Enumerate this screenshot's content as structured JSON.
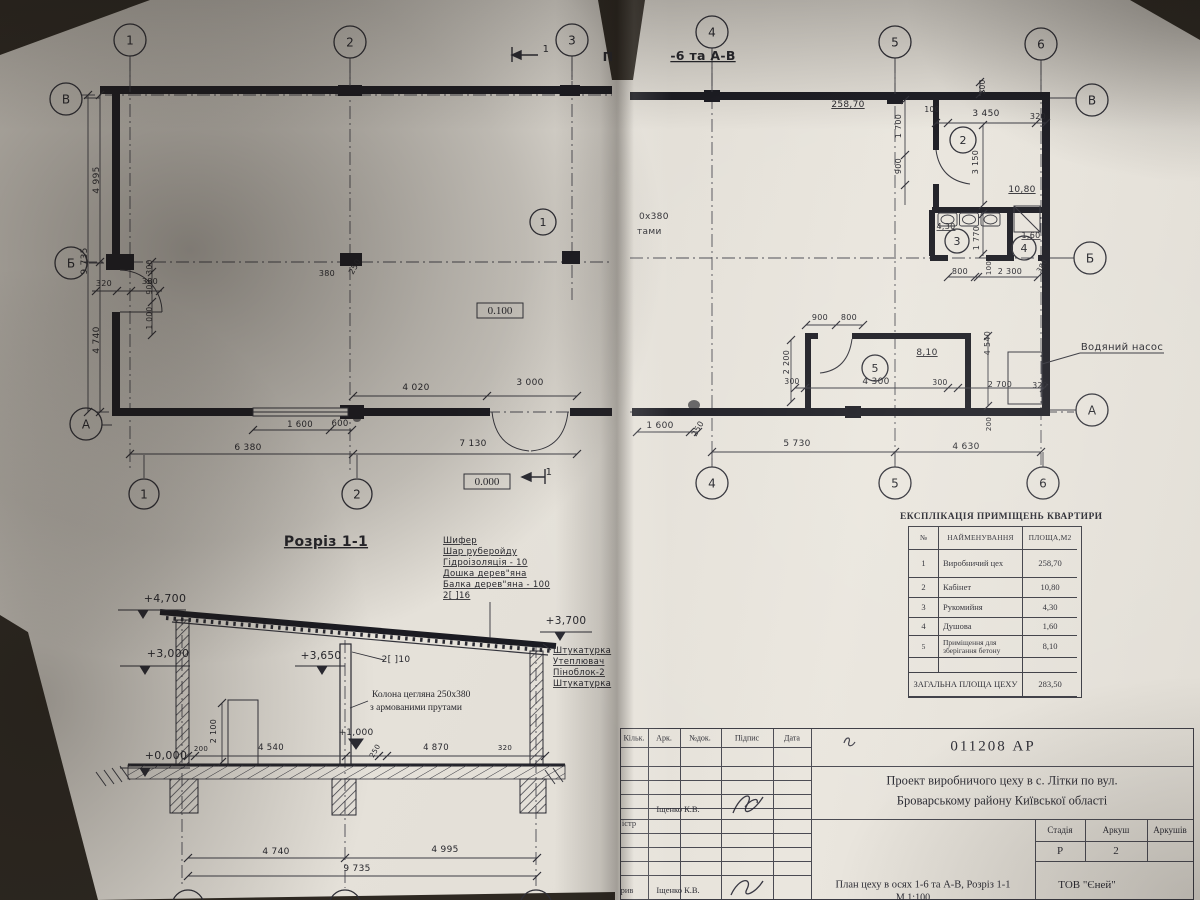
{
  "page": {
    "background": "#342e27",
    "paper": "#e6e2da",
    "ink": "#26262e"
  },
  "drawing": {
    "labels": [
      {
        "t": "П",
        "x": 608,
        "y": 61,
        "s": 12.5,
        "b": 1,
        "n": "sheet-title-fragment"
      },
      {
        "t": "-6 та А-В",
        "x": 703,
        "y": 60,
        "s": 12.5,
        "b": 1,
        "u": 1,
        "n": "sheet-title-fragment"
      },
      {
        "t": "4 995",
        "x": 99,
        "y": 180,
        "r": -90
      },
      {
        "t": "9 735",
        "x": 87,
        "y": 261,
        "r": -90
      },
      {
        "t": "4 740",
        "x": 99,
        "y": 340,
        "r": -90
      },
      {
        "t": "320",
        "x": 104,
        "y": 286,
        "s": 8
      },
      {
        "t": "380",
        "x": 150,
        "y": 284,
        "s": 8
      },
      {
        "t": "300",
        "x": 152,
        "y": 267,
        "r": -90,
        "s": 7.5
      },
      {
        "t": "900",
        "x": 152,
        "y": 287,
        "r": -90,
        "s": 7.5
      },
      {
        "t": "1 000",
        "x": 152,
        "y": 318,
        "r": -90,
        "s": 7.5
      },
      {
        "t": "1 600",
        "x": 300,
        "y": 427,
        "s": 8.5
      },
      {
        "t": "600",
        "x": 340,
        "y": 426,
        "s": 8.5
      },
      {
        "t": "6 380",
        "x": 248,
        "y": 450
      },
      {
        "t": "7 130",
        "x": 473,
        "y": 446
      },
      {
        "t": "4 020",
        "x": 416,
        "y": 390
      },
      {
        "t": "3 000",
        "x": 530,
        "y": 385
      },
      {
        "t": "380",
        "x": 327,
        "y": 276,
        "s": 8
      },
      {
        "t": "250",
        "x": 357,
        "y": 268,
        "r": -60,
        "s": 8
      },
      {
        "t": "0.100",
        "x": 500,
        "y": 314,
        "s": 11,
        "f": "serif",
        "n": "level-label"
      },
      {
        "t": "0.000",
        "x": 487,
        "y": 485,
        "s": 11,
        "f": "serif",
        "n": "level-label"
      },
      {
        "t": "1",
        "x": 549,
        "y": 475,
        "s": 10,
        "n": "section-marker-label"
      },
      {
        "t": "1",
        "x": 546,
        "y": 52,
        "s": 10,
        "n": "section-marker-label"
      },
      {
        "t": "258,70",
        "x": 848,
        "y": 107,
        "u": 1
      },
      {
        "t": "200",
        "x": 985,
        "y": 87,
        "r": -90,
        "s": 7.5
      },
      {
        "t": "100",
        "x": 932,
        "y": 112,
        "s": 7.5
      },
      {
        "t": "3 450",
        "x": 986,
        "y": 116
      },
      {
        "t": "320",
        "x": 1038,
        "y": 119,
        "s": 8
      },
      {
        "t": "1 700",
        "x": 901,
        "y": 126,
        "r": -90,
        "s": 8
      },
      {
        "t": "900",
        "x": 901,
        "y": 166,
        "r": -90,
        "s": 8
      },
      {
        "t": "3 150",
        "x": 978,
        "y": 162,
        "r": -90,
        "s": 8
      },
      {
        "t": "10,80",
        "x": 1022,
        "y": 192,
        "u": 1
      },
      {
        "t": "4,30",
        "x": 946,
        "y": 229,
        "u": 1,
        "s": 8
      },
      {
        "t": "1,60",
        "x": 1031,
        "y": 238,
        "u": 1,
        "s": 8
      },
      {
        "t": "1 770",
        "x": 979,
        "y": 238,
        "r": -90,
        "s": 8
      },
      {
        "t": "100",
        "x": 991,
        "y": 268,
        "r": -90,
        "s": 7
      },
      {
        "t": "800",
        "x": 960,
        "y": 274,
        "s": 8
      },
      {
        "t": "2 300",
        "x": 1010,
        "y": 274,
        "s": 8
      },
      {
        "t": "380",
        "x": 1044,
        "y": 267,
        "r": -60,
        "s": 7
      },
      {
        "t": "900",
        "x": 820,
        "y": 320,
        "s": 8
      },
      {
        "t": "800",
        "x": 849,
        "y": 320,
        "s": 8
      },
      {
        "t": "2 200",
        "x": 789,
        "y": 362,
        "r": -90,
        "s": 8
      },
      {
        "t": "300",
        "x": 792,
        "y": 384,
        "s": 7.5
      },
      {
        "t": "4 300",
        "x": 876,
        "y": 384
      },
      {
        "t": "300",
        "x": 940,
        "y": 385,
        "s": 7.5
      },
      {
        "t": "8,10",
        "x": 927,
        "y": 355,
        "u": 1
      },
      {
        "t": "4 540",
        "x": 990,
        "y": 343,
        "r": -90,
        "s": 8
      },
      {
        "t": "2 700",
        "x": 1000,
        "y": 387,
        "s": 8
      },
      {
        "t": "320",
        "x": 1040,
        "y": 388,
        "s": 7.5
      },
      {
        "t": "1 600",
        "x": 660,
        "y": 428
      },
      {
        "t": "250",
        "x": 700,
        "y": 430,
        "r": -60,
        "s": 8
      },
      {
        "t": "5 730",
        "x": 797,
        "y": 446
      },
      {
        "t": "4 630",
        "x": 966,
        "y": 449
      },
      {
        "t": "200",
        "x": 991,
        "y": 424,
        "r": -90,
        "s": 7
      },
      {
        "t": "Водяний насос",
        "x": 1122,
        "y": 350,
        "s": 10,
        "n": "note-water-pump"
      },
      {
        "t": "0х380",
        "x": 639,
        "y": 219,
        "a": "start",
        "s": 9,
        "n": "note-fragment"
      },
      {
        "t": "тами",
        "x": 637,
        "y": 234,
        "a": "start",
        "s": 9,
        "n": "note-fragment"
      },
      {
        "t": "Розріз 1-1",
        "x": 326,
        "y": 546,
        "s": 14,
        "b": 1,
        "u": 1,
        "n": "section-title"
      },
      {
        "t": "Шифер",
        "x": 443,
        "y": 543,
        "a": "start",
        "s": 8.5,
        "u": 1
      },
      {
        "t": "Шар руберойду",
        "x": 443,
        "y": 554,
        "a": "start",
        "s": 8.5,
        "u": 1
      },
      {
        "t": "Гідроізоляція - 10",
        "x": 443,
        "y": 565,
        "a": "start",
        "s": 8.5,
        "u": 1
      },
      {
        "t": "Дошка дерев\"яна",
        "x": 443,
        "y": 576,
        "a": "start",
        "s": 8.5,
        "u": 1
      },
      {
        "t": "Балка дерев\"яна - 100",
        "x": 443,
        "y": 587,
        "a": "start",
        "s": 8.5,
        "u": 1
      },
      {
        "t": "2[ ]16",
        "x": 443,
        "y": 598,
        "a": "start",
        "s": 8.5,
        "u": 1
      },
      {
        "t": "+4,700",
        "x": 165,
        "y": 602,
        "s": 11
      },
      {
        "t": "+3,000",
        "x": 168,
        "y": 657,
        "s": 11
      },
      {
        "t": "+3,650",
        "x": 321,
        "y": 659,
        "s": 10.5
      },
      {
        "t": "+3,700",
        "x": 566,
        "y": 624,
        "s": 10.5
      },
      {
        "t": "+0,000",
        "x": 166,
        "y": 759,
        "s": 11
      },
      {
        "t": "+1,000",
        "x": 356,
        "y": 735,
        "s": 9
      },
      {
        "t": "2[ ]10",
        "x": 396,
        "y": 662,
        "s": 9
      },
      {
        "t": "Колона цегляна 250х380",
        "x": 372,
        "y": 697,
        "a": "start",
        "s": 9.5,
        "f": "serif"
      },
      {
        "t": "з армованими прутами",
        "x": 370,
        "y": 710,
        "a": "start",
        "s": 9.5,
        "f": "serif"
      },
      {
        "t": "Штукатурка",
        "x": 553,
        "y": 653,
        "a": "start",
        "s": 8.5,
        "u": 1
      },
      {
        "t": "Утеплювач",
        "x": 553,
        "y": 664,
        "a": "start",
        "s": 8.5,
        "u": 1
      },
      {
        "t": "Піноблок-2",
        "x": 553,
        "y": 675,
        "a": "start",
        "s": 8.5,
        "u": 1
      },
      {
        "t": "Штукатурка",
        "x": 553,
        "y": 686,
        "a": "start",
        "s": 8.5,
        "u": 1
      },
      {
        "t": "200",
        "x": 201,
        "y": 751,
        "s": 7
      },
      {
        "t": "4 540",
        "x": 271,
        "y": 750,
        "s": 8.5
      },
      {
        "t": "250",
        "x": 377,
        "y": 752,
        "r": -60,
        "s": 7
      },
      {
        "t": "4 870",
        "x": 436,
        "y": 750,
        "s": 8.5
      },
      {
        "t": "320",
        "x": 505,
        "y": 750,
        "s": 7
      },
      {
        "t": "2 100",
        "x": 216,
        "y": 731,
        "r": -90,
        "s": 8
      },
      {
        "t": "4 740",
        "x": 276,
        "y": 854
      },
      {
        "t": "4 995",
        "x": 445,
        "y": 852
      },
      {
        "t": "9 735",
        "x": 357,
        "y": 871
      }
    ],
    "circles": [
      {
        "t": "1",
        "x": 130,
        "y": 40,
        "rd": 16
      },
      {
        "t": "2",
        "x": 350,
        "y": 42,
        "rd": 16
      },
      {
        "t": "3",
        "x": 572,
        "y": 40,
        "rd": 16
      },
      {
        "t": "4",
        "x": 712,
        "y": 32,
        "rd": 16
      },
      {
        "t": "5",
        "x": 895,
        "y": 42,
        "rd": 16
      },
      {
        "t": "6",
        "x": 1041,
        "y": 44,
        "rd": 16
      },
      {
        "t": "В",
        "x": 66,
        "y": 99,
        "rd": 16
      },
      {
        "t": "Б",
        "x": 71,
        "y": 263,
        "rd": 16
      },
      {
        "t": "А",
        "x": 86,
        "y": 424,
        "rd": 16
      },
      {
        "t": "В",
        "x": 1092,
        "y": 100,
        "rd": 16
      },
      {
        "t": "Б",
        "x": 1090,
        "y": 258,
        "rd": 16
      },
      {
        "t": "А",
        "x": 1092,
        "y": 410,
        "rd": 16
      },
      {
        "t": "1",
        "x": 144,
        "y": 494,
        "rd": 15
      },
      {
        "t": "2",
        "x": 357,
        "y": 494,
        "rd": 15
      },
      {
        "t": "4",
        "x": 712,
        "y": 483,
        "rd": 16
      },
      {
        "t": "5",
        "x": 895,
        "y": 483,
        "rd": 16
      },
      {
        "t": "6",
        "x": 1043,
        "y": 483,
        "rd": 16
      },
      {
        "t": "1",
        "x": 543,
        "y": 222,
        "rd": 13
      },
      {
        "t": "2",
        "x": 963,
        "y": 140,
        "rd": 13
      },
      {
        "t": "3",
        "x": 957,
        "y": 241,
        "rd": 12
      },
      {
        "t": "4",
        "x": 1024,
        "y": 248,
        "rd": 12
      },
      {
        "t": "5",
        "x": 875,
        "y": 368,
        "rd": 13
      },
      {
        "t": "",
        "x": 188,
        "y": 906,
        "rd": 16
      },
      {
        "t": "",
        "x": 345,
        "y": 906,
        "rd": 16
      },
      {
        "t": "",
        "x": 536,
        "y": 906,
        "rd": 16
      }
    ]
  },
  "explication": {
    "title": "ЕКСПЛІКАЦІЯ ПРИМІЩЕНЬ КВАРТИРИ",
    "headers": [
      "№",
      "НАЙМЕНУВАННЯ",
      "ПЛОЩА,М2"
    ],
    "rows": [
      {
        "n": "1",
        "name": "Виробничий цех",
        "area": "258,70"
      },
      {
        "n": "2",
        "name": "Кабінет",
        "area": "10,80"
      },
      {
        "n": "3",
        "name": "Рукомийня",
        "area": "4,30"
      },
      {
        "n": "4",
        "name": "Душова",
        "area": "1,60"
      },
      {
        "n": "5",
        "name": "Приміщення для зберігання бетону",
        "area": "8,10"
      },
      {
        "n": "",
        "name": "",
        "area": ""
      }
    ],
    "total_label": "ЗАГАЛЬНА ПЛОЩА ЦЕХУ",
    "total": "283,50"
  },
  "title_block": {
    "doc_number": "011208 АР",
    "cols": [
      "Кільк.",
      "Арк.",
      "№док.",
      "Підпис",
      "Дата"
    ],
    "project_line1": "Проект виробничого цеху в с. Літки по вул.",
    "project_line2": "Броварському району Київської області",
    "author1": "Іщенко К.В.",
    "author2": "Іщенко К.В.",
    "left_fragment1": "істр",
    "left_fragment2": "рив",
    "stage_label": "Стадія",
    "sheet_label": "Аркуш",
    "sheets_label": "Аркушів",
    "stage": "Р",
    "sheet": "2",
    "sheets": "",
    "drawing_title": "План цеху в осях 1-6 та А-В, Розріз 1-1",
    "scale": "М 1:100",
    "company": "ТОВ \"Єней\""
  }
}
